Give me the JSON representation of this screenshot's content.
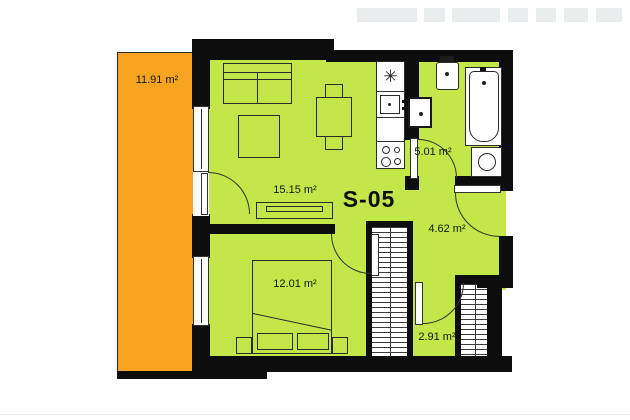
{
  "unit": {
    "code": "S-05"
  },
  "rooms": {
    "balcony": {
      "area": "11.91 m²"
    },
    "living_kitchen": {
      "area": "15.15 m²"
    },
    "bathroom": {
      "area": "5.01 m²"
    },
    "hallway": {
      "area": "4.62 m²"
    },
    "bedroom": {
      "area": "12.01 m²"
    },
    "storage": {
      "area": "2.91 m²"
    }
  },
  "symbols": {
    "boiler_star": "✳"
  },
  "colors": {
    "floor": "#c3e648",
    "balcony": "#f7a521",
    "wall": "#0d0d0d",
    "fixture": "#ffffff",
    "faded_neighbor": "#e9ecec"
  }
}
